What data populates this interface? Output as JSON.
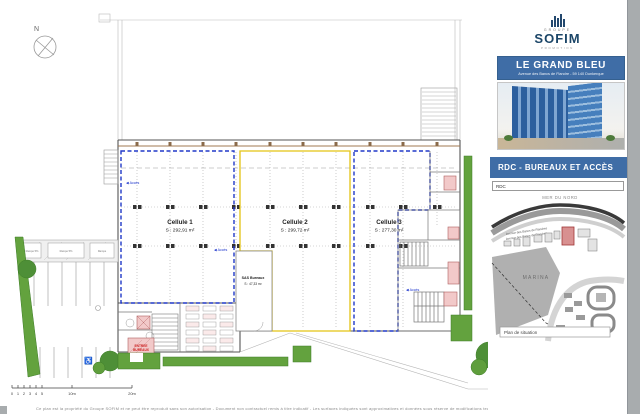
{
  "document": {
    "compass_label": "N",
    "footer_disclaimer": "Ce plan est la propriété du Groupe SOFIM et ne peut être reproduit sans son autorisation - Document non contractuel remis à titre indicatif - Les surfaces indiquées sont approximatives et données sous réserve de modifications techniques - Le Grand Bleu - Dunkerque - RDC Bureaux et accès"
  },
  "plan": {
    "cells": [
      {
        "name": "Cellule 1",
        "area": "S : 292,91 m²"
      },
      {
        "name": "Cellule 2",
        "area": "S : 299,72 m²"
      },
      {
        "name": "Cellule 3",
        "area": "S : 277,30 m²"
      }
    ],
    "sas": {
      "name": "SAS Bureaux",
      "area": "S : 47,33 m²"
    },
    "entrance_label_line1": "ENTREE",
    "entrance_label_line2": "BUREAUX",
    "entry_marker_label": "◀ Accès",
    "parking_ramp_labels": [
      "Rampe 5%",
      "Rampe 5%",
      "Rampe"
    ],
    "scale_ticks": [
      "0",
      "1",
      "2",
      "3",
      "4",
      "5",
      "10m",
      "20m"
    ]
  },
  "panel": {
    "logo": {
      "group": "GROUPE",
      "name": "SOFIM",
      "tagline": "PROMOTION"
    },
    "banner": {
      "title": "LE GRAND BLEU",
      "subtitle": "Avenue des Bancs de Flandre - 59 140 Dunkerque"
    },
    "section_title": "RDC - BUREAUX ET ACCÈS",
    "level_label": "RDC",
    "map": {
      "sea": "MER DU NORD",
      "marina": "MARINA",
      "street1": "Avenue des Bancs de Flandres",
      "street2": "Avenue des Bancs de Flandres",
      "caption": "Plan de situation"
    }
  },
  "colors": {
    "banner_blue": "#3f6da6",
    "cell13_outline": "#2038c8",
    "cell2_outline": "#e3c413",
    "site_red": "#c0392b",
    "green": "#5f9e3c"
  }
}
